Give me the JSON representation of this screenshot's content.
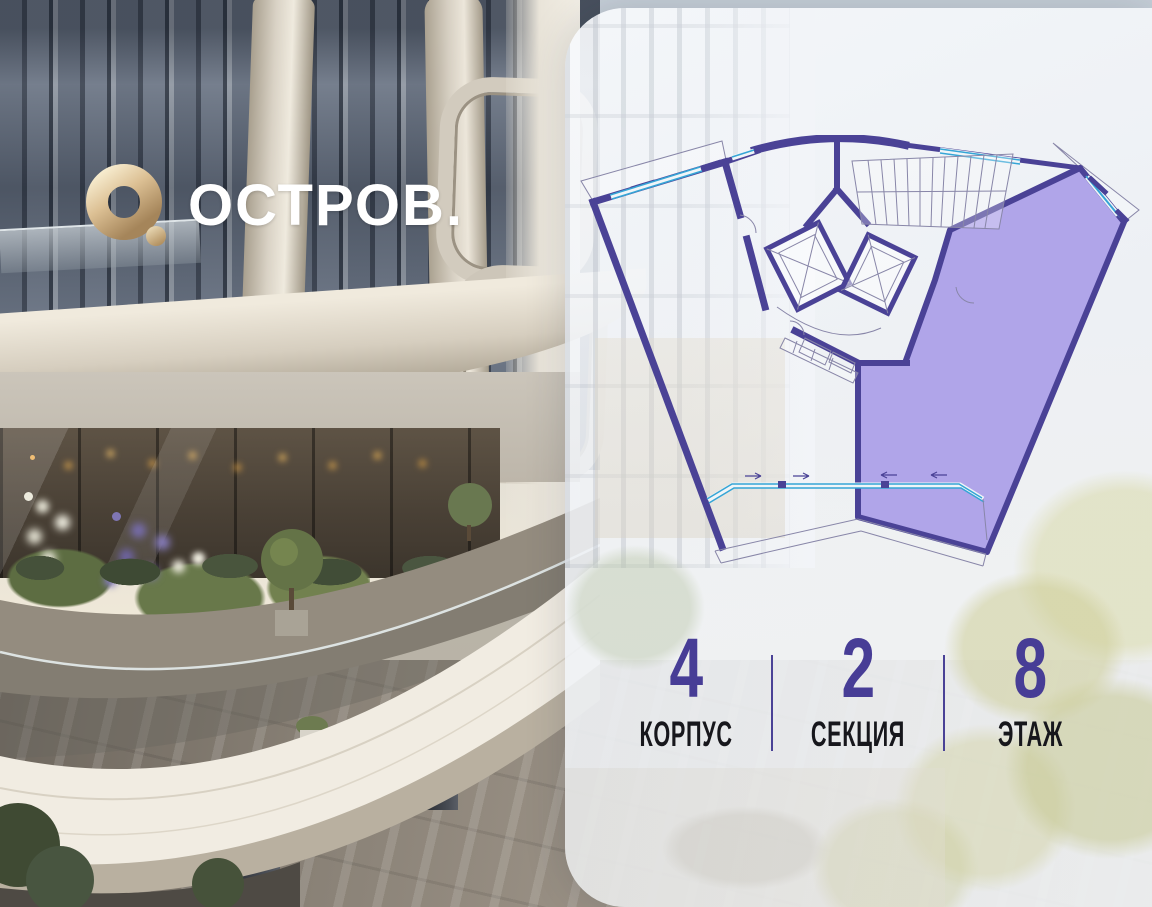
{
  "brand": {
    "name": "ОСТРОВ.",
    "mark": "gold-ring-with-dot"
  },
  "apartment_card": {
    "floor_plan": {
      "type": "building-section-plan",
      "selected_wing": "right",
      "wings": [
        {
          "id": "left-wing",
          "state": "available-outline"
        },
        {
          "id": "right-wing",
          "state": "selected-highlight"
        }
      ],
      "core_elements": [
        "stairs",
        "elevator-1",
        "elevator-2",
        "doors",
        "windows"
      ]
    },
    "info": {
      "items": [
        {
          "value": "4",
          "label": "КОРПУС"
        },
        {
          "value": "2",
          "label": "СЕКЦИЯ"
        },
        {
          "value": "8",
          "label": "ЭТАЖ"
        }
      ]
    }
  },
  "colors": {
    "accent_indigo": "#4a4296",
    "selected_fill": "#a99ce8",
    "window_teal": "#35a5d6",
    "logo_gold": "#d9bd8e",
    "panel_background": "#f2f4f8"
  }
}
